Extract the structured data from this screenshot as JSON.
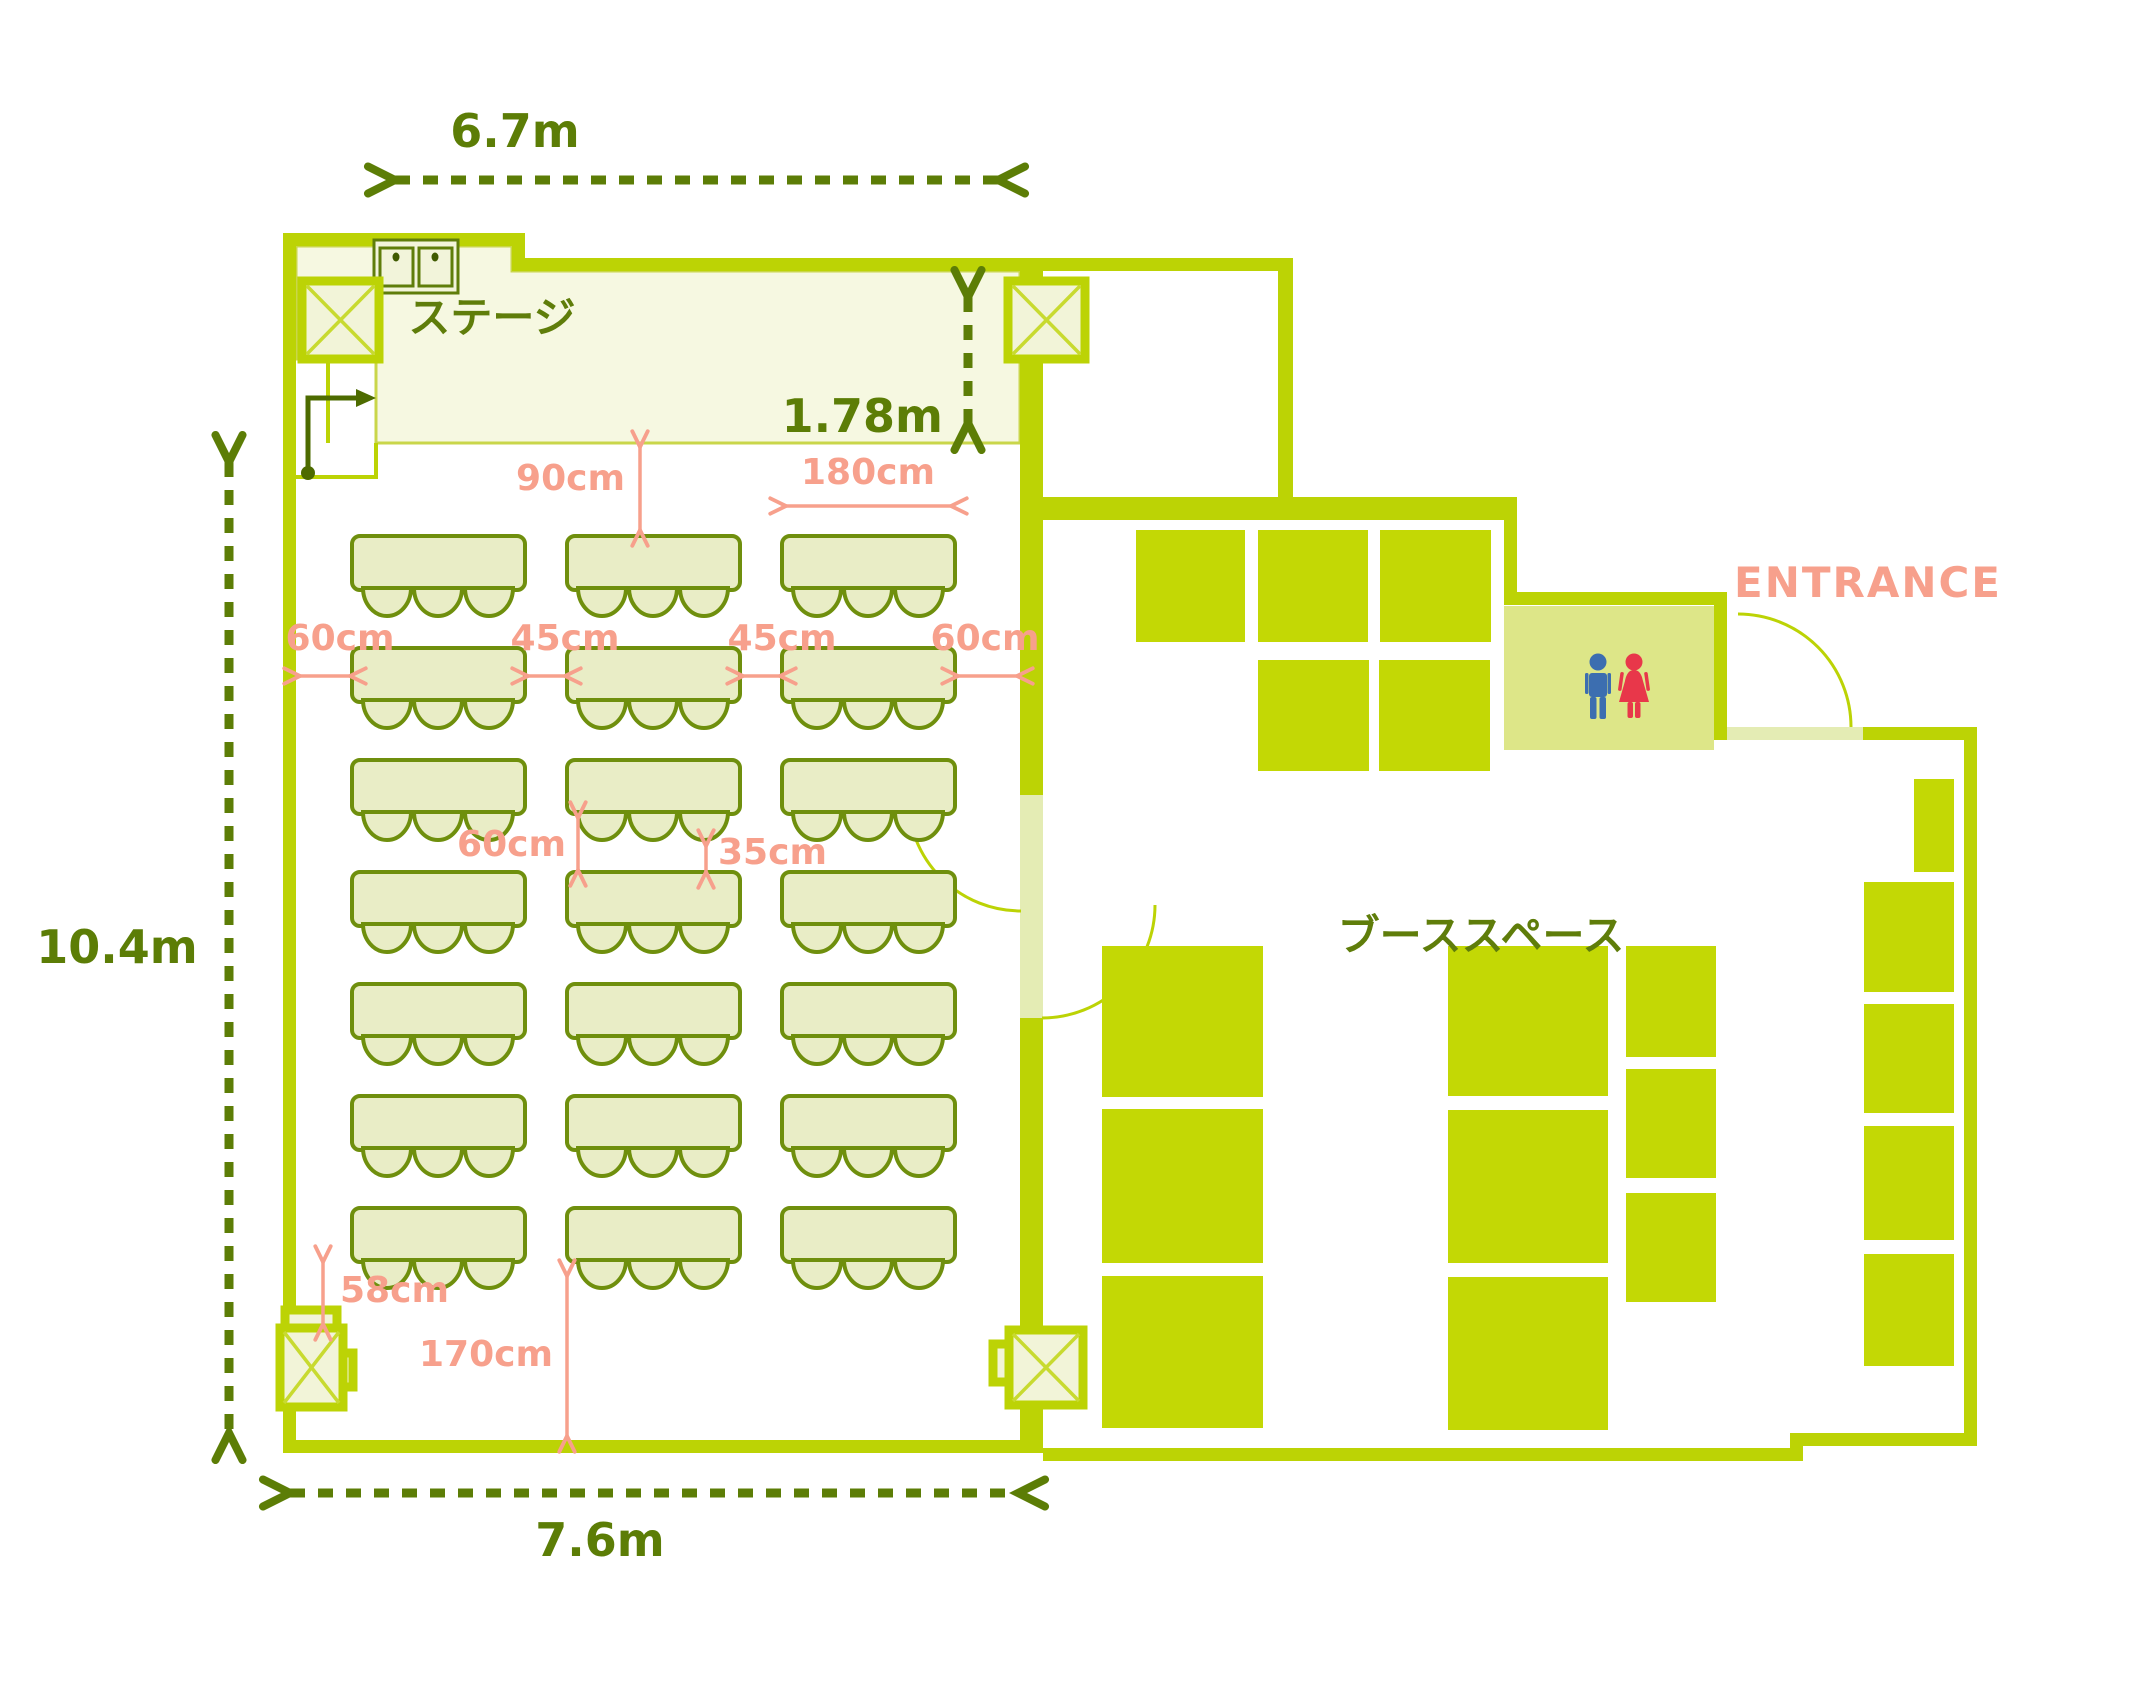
{
  "labels": {
    "stage": "ステージ",
    "booth": "ブーススペース",
    "entrance": "ENTRANCE"
  },
  "dims": {
    "top_width": "6.7m",
    "left_height": "10.4m",
    "bottom_width": "7.6m",
    "stage_depth": "1.78m",
    "stage_front": "90cm",
    "table_width": "180cm",
    "left_gap": "60cm",
    "col_gap_1": "45cm",
    "col_gap_2": "45cm",
    "right_gap": "60cm",
    "row_gap": "60cm",
    "chair_clearance": "35cm",
    "pillar_gap": "58cm",
    "rear_space": "170cm"
  },
  "stats": {
    "seminar_tables": 21,
    "chairs_per_table": 3,
    "booth_blocks": 16
  },
  "colors": {
    "wall_green": "#bcd305",
    "booth_green": "#c3d805",
    "stage_fill": "#f6f8e1",
    "furniture_fill": "#e9edc6",
    "furniture_stroke": "#6f8f0d",
    "dimension_green": "#5c7d06",
    "dimension_salmon": "#f7a08c",
    "toilet_fill": "#dde688",
    "male_blue": "#3c6eb0",
    "female_red": "#e8374a"
  }
}
